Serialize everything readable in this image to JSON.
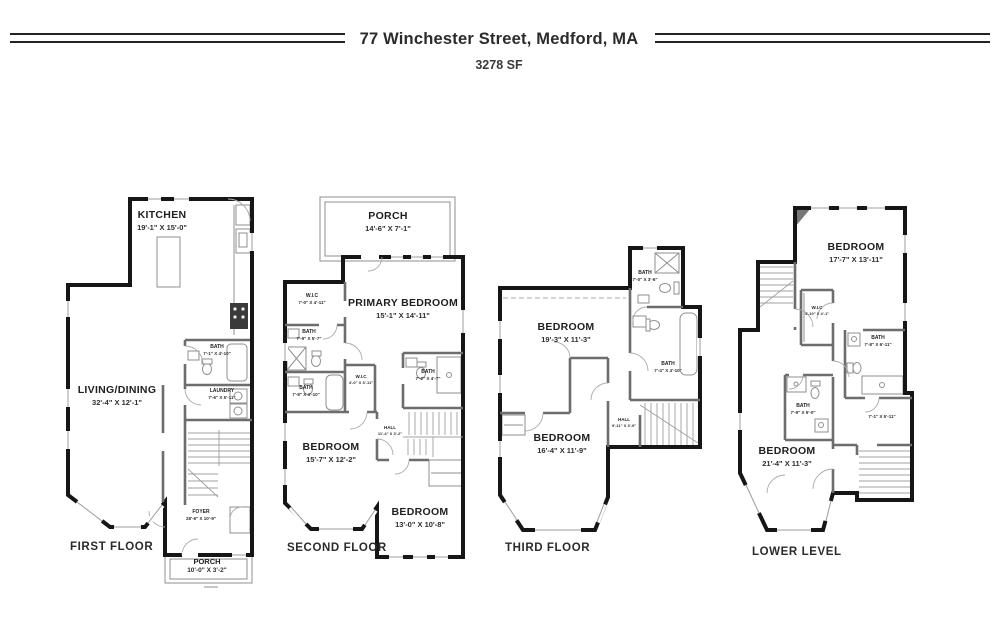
{
  "header": {
    "title": "77 Winchester Street, Medford, MA",
    "subtitle": "3278 SF"
  },
  "floors": {
    "first": {
      "name": "FIRST FLOOR",
      "rooms": {
        "kitchen": {
          "label": "KITCHEN",
          "dims": "19'-1\" X 15'-0\""
        },
        "living": {
          "label": "LIVING/DINING",
          "dims": "32'-4\" X 12'-1\""
        },
        "bath": {
          "label": "BATH",
          "dims": "7'-1\" X 4'-10\""
        },
        "laundry": {
          "label": "LAUNDRY",
          "dims": "7'-6\" X 5'-11\""
        },
        "foyer": {
          "label": "FOYER",
          "dims": "28'-6\" X 10'-9\""
        },
        "porch": {
          "label": "PORCH",
          "dims": "10'-0\" X 3'-2\""
        }
      }
    },
    "second": {
      "name": "SECOND FLOOR",
      "rooms": {
        "porch": {
          "label": "PORCH",
          "dims": "14'-6\" X 7'-1\""
        },
        "primary": {
          "label": "PRIMARY BEDROOM",
          "dims": "15'-1\" X 14'-11\""
        },
        "wic1": {
          "label": "W.I.C",
          "dims": "7'-0\" X 4'-11\""
        },
        "bath1": {
          "label": "BATH",
          "dims": "7'-9\" X 5'-7\""
        },
        "bath2": {
          "label": "BATH",
          "dims": "7'-8\" X 4'-10\""
        },
        "wic2": {
          "label": "W.I.C",
          "dims": "4'-0\" X 3'-11\""
        },
        "bath3": {
          "label": "BATH",
          "dims": "7'-2\" X 4'-7\""
        },
        "hall": {
          "label": "HALL",
          "dims": "11'-4\" X 3'-2\""
        },
        "bedroom1": {
          "label": "BEDROOM",
          "dims": "15'-7\" X 12'-2\""
        },
        "bedroom2": {
          "label": "BEDROOM",
          "dims": "13'-0\" X 10'-8\""
        }
      }
    },
    "third": {
      "name": "THIRD FLOOR",
      "rooms": {
        "bath1": {
          "label": "BATH",
          "dims": "7'-0\" X 3'-6\""
        },
        "bedroom1": {
          "label": "BEDROOM",
          "dims": "19'-3\" X 11'-3\""
        },
        "bath2": {
          "label": "BATH",
          "dims": "7'-4\" X 4'-10\""
        },
        "hall": {
          "label": "HALL",
          "dims": "9'-11\" X 3'-9\""
        },
        "bedroom2": {
          "label": "BEDROOM",
          "dims": "16'-4\" X 11'-9\""
        }
      }
    },
    "lower": {
      "name": "LOWER LEVEL",
      "rooms": {
        "bedroom1": {
          "label": "BEDROOM",
          "dims": "17'-7\" X 13'-11\""
        },
        "wic": {
          "label": "W.I.C",
          "dims": "4'-10\" X 4'-1\""
        },
        "bath1": {
          "label": "BATH",
          "dims": "7'-8\" X 6'-11\""
        },
        "bath2": {
          "label": "BATH",
          "dims": "7'-9\" X 5'-0\""
        },
        "room": {
          "label": "",
          "dims": "7'-1\" X 5'-11\""
        },
        "bedroom2": {
          "label": "BEDROOM",
          "dims": "21'-4\" X 11'-3\""
        }
      }
    }
  },
  "colors": {
    "wall": "#161616",
    "interior_wall": "#6d6d6d",
    "text": "#1f1f1f"
  }
}
